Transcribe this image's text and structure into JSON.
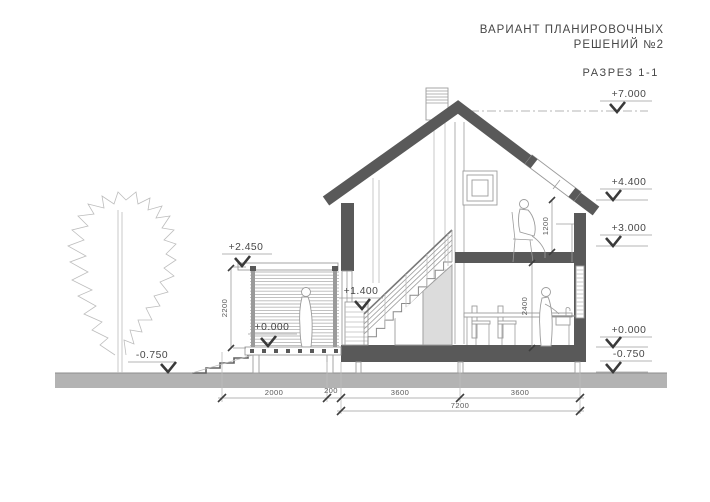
{
  "header": {
    "title_line1": "ВАРИАНТ ПЛАНИРОВОЧНЫХ",
    "title_line2": "РЕШЕНИЙ №2",
    "drawing_label": "РАЗРЕЗ 1-1"
  },
  "colors": {
    "section_cut": "#595959",
    "ground": "#b3b3b3",
    "outline": "#9c9c9c",
    "text": "#474747",
    "storage_fill": "#dcdcdc"
  },
  "marks_right": [
    {
      "value": "+7.000"
    },
    {
      "value": "+4.400"
    },
    {
      "value": "+3.000"
    },
    {
      "value": "+0.000"
    },
    {
      "value": "-0.750"
    }
  ],
  "marks_building": [
    {
      "value": "+2.450"
    },
    {
      "value": "+1.400"
    },
    {
      "value": "+0.000"
    },
    {
      "value": "-0.750"
    }
  ],
  "dimensions": {
    "horizontal": [
      "2000",
      "200",
      "3600",
      "3600"
    ],
    "total_width": "7200",
    "terrace_height": "2200",
    "attic_knee_height": "1200",
    "floor_height": "2400"
  }
}
